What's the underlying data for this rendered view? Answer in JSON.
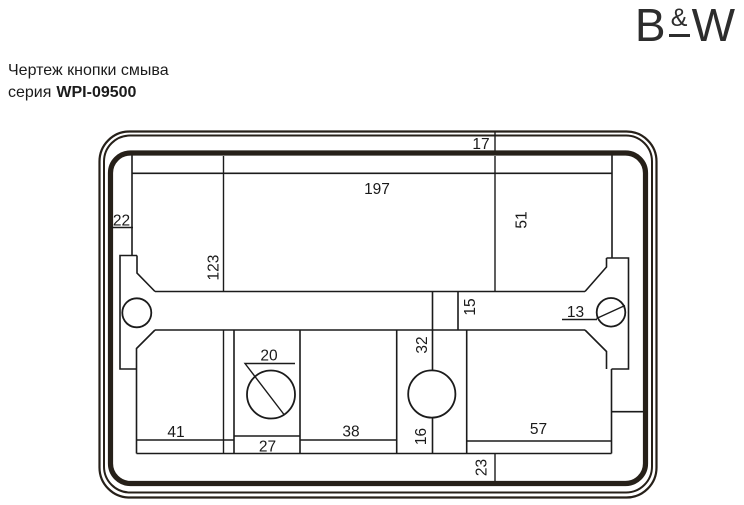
{
  "header": {
    "title": "Чертеж кнопки смыва",
    "series_label": "серия",
    "series_code": "WPI-09500"
  },
  "logo": {
    "letter_left": "B",
    "ampersand": "&",
    "letter_right": "W"
  },
  "drawing": {
    "dims": {
      "rim_top": "17",
      "inner_width": "197",
      "rim_left": "22",
      "upper_height": "51",
      "inner_height": "123",
      "crossbar_height": "15",
      "screw_hole_dia": "13",
      "button_hole_dia": "20",
      "button_offset": "32",
      "seg_left": "41",
      "seg_center": "27",
      "seg_mid": "38",
      "hole_bottom_gap": "16",
      "seg_right": "57",
      "rim_bottom": "23"
    }
  },
  "colors": {
    "line": "#1b1b1b",
    "frame": "#262019",
    "text": "#1a1a1a"
  }
}
